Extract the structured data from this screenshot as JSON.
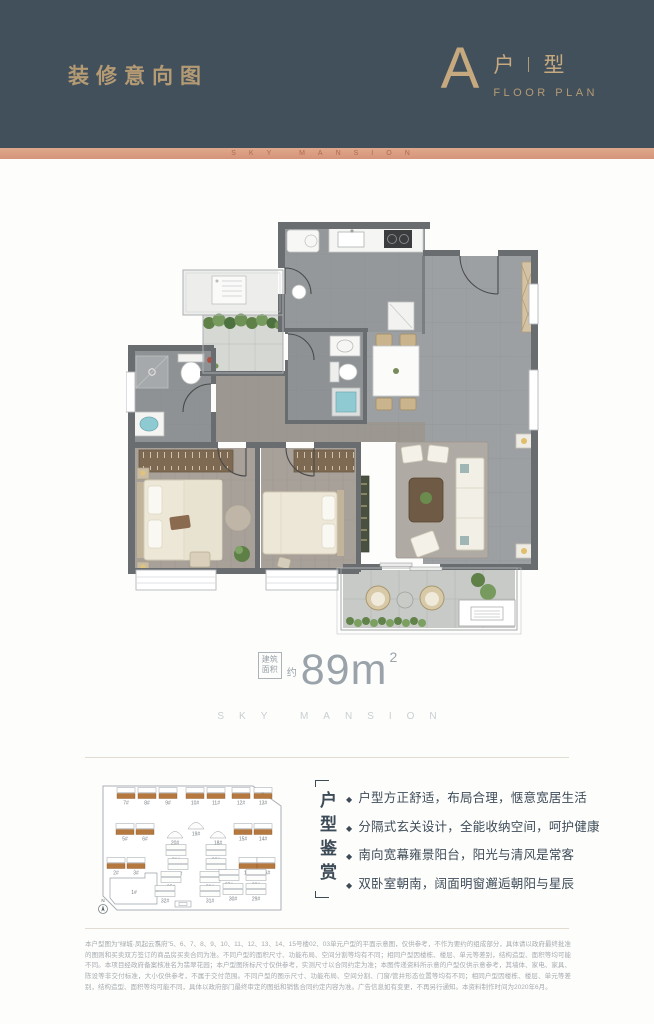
{
  "header": {
    "title": "装修意向图",
    "plan_letter": "A",
    "plan_char_1": "户",
    "plan_char_2": "型",
    "plan_subtitle": "FLOOR PLAN"
  },
  "brand_band": {
    "text": "SKY MANSION"
  },
  "area": {
    "box_line1": "建筑",
    "box_line2": "面积",
    "approx": "约",
    "value": "89",
    "unit": "m",
    "superscript": "2",
    "brand": "SKY MANSION"
  },
  "features": {
    "vertical_label": "户型鉴赏",
    "items": [
      "户型方正舒适，布局合理，惬意宽居生活",
      "分隔式玄关设计，全能收纳空间，呵护健康",
      "南向宽幕雍景阳台，阳光与清风是常客",
      "双卧室朝南，阔面明窗邂逅朝阳与星辰"
    ]
  },
  "site_plan": {
    "compass_label": "N",
    "buildings": [
      {
        "label": "7#",
        "x": 31,
        "y": 30,
        "t": "o"
      },
      {
        "label": "8#",
        "x": 52,
        "y": 30,
        "t": "o"
      },
      {
        "label": "9#",
        "x": 73,
        "y": 30,
        "t": "o"
      },
      {
        "label": "10#",
        "x": 100,
        "y": 30,
        "t": "o"
      },
      {
        "label": "11#",
        "x": 121,
        "y": 30,
        "t": "o"
      },
      {
        "label": "12#",
        "x": 146,
        "y": 30,
        "t": "o"
      },
      {
        "label": "13#",
        "x": 168,
        "y": 30,
        "t": "o"
      },
      {
        "label": "5#",
        "x": 30,
        "y": 66,
        "t": "o"
      },
      {
        "label": "6#",
        "x": 50,
        "y": 66,
        "t": "o"
      },
      {
        "label": "20#",
        "x": 80,
        "y": 70,
        "t": "t"
      },
      {
        "label": "19#",
        "x": 101,
        "y": 61,
        "t": "t"
      },
      {
        "label": "18#",
        "x": 123,
        "y": 70,
        "t": "t"
      },
      {
        "label": "15#",
        "x": 148,
        "y": 66,
        "t": "o"
      },
      {
        "label": "14#",
        "x": 168,
        "y": 66,
        "t": "o"
      },
      {
        "label": "21#",
        "x": 81,
        "y": 87,
        "t": "p"
      },
      {
        "label": "22#",
        "x": 121,
        "y": 87,
        "t": "p"
      },
      {
        "label": "2#",
        "x": 21,
        "y": 100,
        "t": "o"
      },
      {
        "label": "3#",
        "x": 41,
        "y": 100,
        "t": "o"
      },
      {
        "label": "24#",
        "x": 83,
        "y": 101,
        "t": "p"
      },
      {
        "label": "23#",
        "x": 121,
        "y": 101,
        "t": "p"
      },
      {
        "label": "17#",
        "x": 153,
        "y": 100,
        "t": "o"
      },
      {
        "label": "16#",
        "x": 171,
        "y": 100,
        "t": "o"
      },
      {
        "label": "1#",
        "x": 33,
        "y": 122,
        "t": "big"
      },
      {
        "label": "25#",
        "x": 76,
        "y": 114,
        "t": "p"
      },
      {
        "label": "26#",
        "x": 115,
        "y": 114,
        "t": "p"
      },
      {
        "label": "27#",
        "x": 134,
        "y": 112,
        "t": "p"
      },
      {
        "label": "28#",
        "x": 161,
        "y": 112,
        "t": "p"
      },
      {
        "label": "32#",
        "x": 70,
        "y": 128,
        "t": "p"
      },
      {
        "label": "31#",
        "x": 115,
        "y": 128,
        "t": "p"
      },
      {
        "label": "30#",
        "x": 138,
        "y": 126,
        "t": "p"
      },
      {
        "label": "29#",
        "x": 161,
        "y": 126,
        "t": "p"
      }
    ]
  },
  "disclaimer": {
    "text": "本户型图为“绿城·凤起云翥府”5、6、7、8、9、10、11、12、13、14、15号楼02、03单元户型的平面示意图，仅供参考，不作为要约的组成部分，具体请以政府最终批准的图则和买卖双方签订的商品房买卖合同为准。不同户型的面积尺寸、功能布局、空间分割等均有不同；相同户型因楼栋、楼层、单元等差别，结构造型、面积等均可能不同。本项目经政府备案核准名为翡翠花园；本户型图所标尺寸仅供参考，实测尺寸以合同约定为准；本图传递资料所示意的户型仅供示意参考，其墙体、家电、家具、陈设等非交付标准，大小仅供参考，不属于交付范围。不同户型的图示尺寸、功能布局、空间分割、门窗/管井形态位置等均有不同；相同户型因楼栋、楼层、单元等差别，结构造型、面积等均可能不同，具体以政府部门最终审定的图纸和销售合同约定内容为准。广告信息如有变更，不再另行通知。本资料制作时间为2020年6月。"
  },
  "colors": {
    "header_bg": "#42505C",
    "gold": "#B89C75",
    "copper_band": "#D89B80",
    "accent_text": "#3D4B57",
    "highlight_building": "#B5793F"
  }
}
